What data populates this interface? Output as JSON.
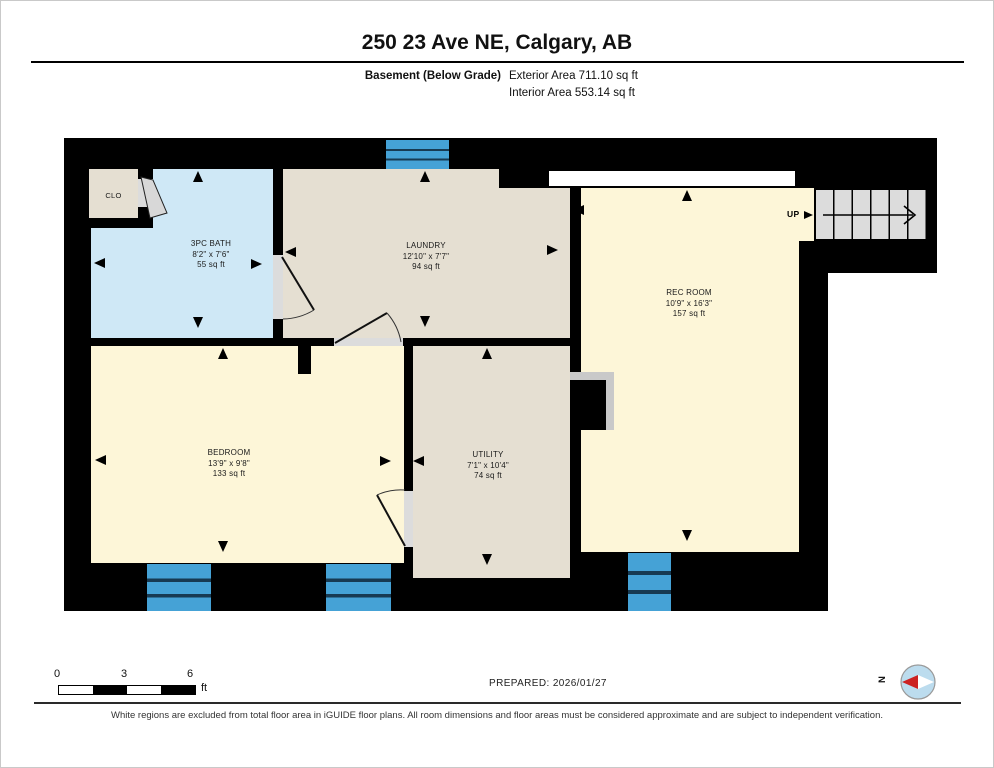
{
  "header": {
    "title": "250 23 Ave NE, Calgary, AB",
    "floor_label": "Basement (Below Grade)",
    "exterior_area": "Exterior Area 711.10 sq ft",
    "interior_area": "Interior Area 553.14 sq ft"
  },
  "rooms": [
    {
      "name": "CLO",
      "dims": "",
      "area": ""
    },
    {
      "name": "3PC BATH",
      "dims": "8'2\" x 7'6\"",
      "area": "55 sq ft"
    },
    {
      "name": "LAUNDRY",
      "dims": "12'10\" x 7'7\"",
      "area": "94 sq ft"
    },
    {
      "name": "REC ROOM",
      "dims": "10'9\" x 16'3\"",
      "area": "157 sq ft"
    },
    {
      "name": "BEDROOM",
      "dims": "13'9\" x 9'8\"",
      "area": "133 sq ft"
    },
    {
      "name": "UTILITY",
      "dims": "7'1\" x 10'4\"",
      "area": "74 sq ft"
    }
  ],
  "stairs": {
    "up_label": "UP"
  },
  "scale_bar": {
    "tick_0": "0",
    "tick_3": "3",
    "tick_6": "6",
    "unit": "ft"
  },
  "prepared": "PREPARED: 2026/01/27",
  "compass": {
    "north_label": "N"
  },
  "footer_note": "White regions are excluded from total floor area in iGUIDE floor plans. All room dimensions and floor areas must be considered approximate and are subject to independent verification.",
  "colors": {
    "wall": "#000000",
    "room_tan": "#e5dfd2",
    "room_cream": "#fdf6d8",
    "room_bath_blue": "#cfe8f6",
    "window_blue": "#45a2d6",
    "stairs_gray": "#dcdcdc",
    "compass_fill": "#bcdcee",
    "compass_needle_red": "#cc2222"
  }
}
